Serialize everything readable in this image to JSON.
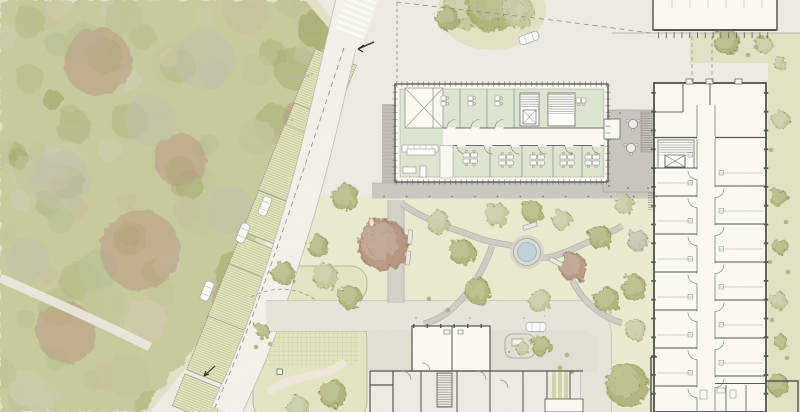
{
  "meta": {
    "type": "architectural-site-plan",
    "canvas": {
      "w": 800,
      "h": 412
    },
    "visible_text_labels": []
  },
  "colors": {
    "ground": "#edece4",
    "veg_margin": "#e2e3c5",
    "forest_base": "#c9cd9f",
    "lawn": "#eaebd0",
    "island": "#e3e6c3",
    "strip_green": "#cdd49e",
    "hatch_white": "#f1f1e3",
    "road_main": "#f3f2ec",
    "road_edge": "#c0beb1",
    "road_lower": "#e7e5dc",
    "forecourt": "#e2e0d7",
    "walkway": "#cac9c3",
    "paver": "#c0bfb9",
    "terrace": "#c7c6c1",
    "room_green": "#e0e5d2",
    "building_white": "#fbfaf5",
    "wall_dark": "#4f4f49",
    "wall_mid": "#8a8a82",
    "pond_water": "#c2d3de",
    "pond_ring": "#dddcd4",
    "car_body": "#fcfcfa",
    "tree_olive": "#a9b173",
    "tree_sage": "#c2c69a",
    "tree_red": "#b2907b",
    "tree_gray": "#bcc0aa"
  },
  "vegetation": {
    "forest": {
      "seed": 13,
      "scatter_count": 115,
      "palette": [
        "#b6bc84",
        "#c4c89c",
        "#aeb47a",
        "#cfd0ae",
        "#a6ae6e",
        "#c8c3a0",
        "#bdc49a"
      ],
      "red_blobs": [
        [
          98,
          62,
          34
        ],
        [
          140,
          250,
          40
        ],
        [
          66,
          332,
          30
        ],
        [
          238,
          300,
          26
        ],
        [
          305,
          118,
          22
        ],
        [
          180,
          160,
          26
        ]
      ],
      "gray_blobs": [
        [
          205,
          60,
          30
        ],
        [
          150,
          120,
          26
        ],
        [
          60,
          180,
          30
        ],
        [
          230,
          210,
          24
        ],
        [
          28,
          260,
          22
        ]
      ]
    },
    "trees": [
      [
        345,
        197,
        14,
        "o"
      ],
      [
        318,
        246,
        11,
        "o"
      ],
      [
        350,
        297,
        12,
        "o"
      ],
      [
        383,
        245,
        26,
        "r"
      ],
      [
        438,
        222,
        12,
        "s"
      ],
      [
        462,
        252,
        13,
        "o"
      ],
      [
        497,
        215,
        12,
        "s"
      ],
      [
        533,
        212,
        11,
        "o"
      ],
      [
        562,
        220,
        10,
        "s"
      ],
      [
        573,
        267,
        14,
        "r"
      ],
      [
        600,
        237,
        12,
        "o"
      ],
      [
        624,
        204,
        10,
        "s"
      ],
      [
        478,
        291,
        13,
        "o"
      ],
      [
        540,
        301,
        12,
        "s"
      ],
      [
        607,
        300,
        13,
        "o"
      ],
      [
        636,
        330,
        11,
        "s"
      ],
      [
        638,
        241,
        11,
        "g"
      ],
      [
        634,
        288,
        13,
        "o"
      ],
      [
        627,
        385,
        22,
        "o"
      ],
      [
        283,
        273,
        12,
        "o"
      ],
      [
        325,
        276,
        13,
        "s"
      ],
      [
        333,
        394,
        14,
        "o"
      ],
      [
        298,
        407,
        11,
        "s"
      ],
      [
        262,
        330,
        7,
        "o"
      ],
      [
        465,
        8,
        22,
        "s"
      ],
      [
        492,
        6,
        26,
        "o"
      ],
      [
        518,
        12,
        17,
        "s"
      ],
      [
        447,
        18,
        12,
        "o"
      ],
      [
        727,
        42,
        13,
        "o"
      ],
      [
        764,
        45,
        9,
        "s"
      ],
      [
        780,
        63,
        7,
        "s"
      ],
      [
        781,
        120,
        9,
        "s"
      ],
      [
        779,
        198,
        9,
        "o"
      ],
      [
        781,
        247,
        8,
        "o"
      ],
      [
        778,
        300,
        9,
        "s"
      ],
      [
        781,
        342,
        7,
        "o"
      ],
      [
        778,
        385,
        11,
        "o"
      ],
      [
        541,
        346,
        10,
        "o"
      ],
      [
        522,
        348,
        7,
        "s"
      ]
    ],
    "shrub_dots": [
      [
        756,
        47
      ],
      [
        762,
        37
      ],
      [
        748,
        55
      ],
      [
        771,
        150
      ],
      [
        786,
        222
      ],
      [
        770,
        262
      ],
      [
        788,
        272
      ],
      [
        772,
        320
      ],
      [
        787,
        358
      ],
      [
        262,
        338
      ],
      [
        270,
        344
      ],
      [
        256,
        347
      ],
      [
        429,
        299
      ],
      [
        448,
        310
      ],
      [
        567,
        355
      ],
      [
        560,
        368
      ],
      [
        572,
        372
      ]
    ]
  },
  "parking": {
    "angle_deg": 112,
    "strip_width": 44,
    "strips": [
      [
        325,
        84,
        58
      ],
      [
        310,
        123,
        26
      ],
      [
        292,
        165,
        70
      ],
      [
        271,
        219,
        44
      ],
      [
        255,
        258,
        30
      ],
      [
        238,
        300,
        60
      ],
      [
        218,
        351,
        58
      ],
      [
        199,
        398,
        34
      ]
    ],
    "cars": [
      [
        265,
        206,
        112
      ],
      [
        243,
        233,
        112
      ],
      [
        207,
        291,
        112
      ]
    ]
  },
  "vehicles": {
    "other_cars": [
      [
        529,
        38,
        -20
      ],
      [
        536,
        327,
        1
      ]
    ]
  },
  "hardscape": {
    "pond": {
      "x": 527,
      "y": 252,
      "r": 9.5
    },
    "benches": [
      [
        530,
        226,
        -18
      ],
      [
        556,
        262,
        28
      ],
      [
        410,
        237,
        95
      ],
      [
        408,
        258,
        95
      ]
    ],
    "terrace_tables": [
      [
        633,
        124
      ],
      [
        631,
        148
      ]
    ],
    "bollards": {
      "y": 196.5,
      "x0": 384,
      "x1": 657,
      "step": 22.7
    },
    "terrace_dots": [
      [
        609,
        116
      ],
      [
        609,
        152
      ],
      [
        609,
        186
      ],
      [
        628,
        188
      ],
      [
        648,
        188
      ],
      [
        620,
        113
      ]
    ],
    "road_dots": [
      [
        416,
        318
      ],
      [
        470,
        318
      ],
      [
        524,
        318
      ],
      [
        292,
        120
      ],
      [
        312,
        74
      ]
    ]
  },
  "central_building": {
    "desk_pairs": [
      [
        441,
        96
      ],
      [
        468,
        96
      ],
      [
        495,
        96
      ]
    ],
    "desk_pairs_rot": [
      [
        586,
        98
      ]
    ],
    "desk_clusters": [
      [
        470,
        158
      ],
      [
        506,
        160
      ],
      [
        537,
        160
      ],
      [
        567,
        160
      ],
      [
        592,
        160
      ]
    ],
    "open_tables": [
      [
        407,
        149,
        28,
        6
      ],
      [
        403,
        167,
        13,
        6
      ],
      [
        420,
        166,
        6,
        11
      ]
    ],
    "top_divider_x": [
      433,
      460,
      487,
      514
    ],
    "bottom_divider_x": [
      490,
      522,
      553,
      582
    ],
    "top_door_x": [
      447,
      471,
      495
    ],
    "bottom_door_x": [
      457,
      484,
      511,
      538,
      565,
      592
    ]
  },
  "right_building": {
    "left_room_wall_y": [
      168,
      196,
      234,
      272,
      310,
      348,
      386
    ],
    "right_room_wall_y": [
      186,
      224,
      262,
      300,
      338,
      376
    ]
  }
}
